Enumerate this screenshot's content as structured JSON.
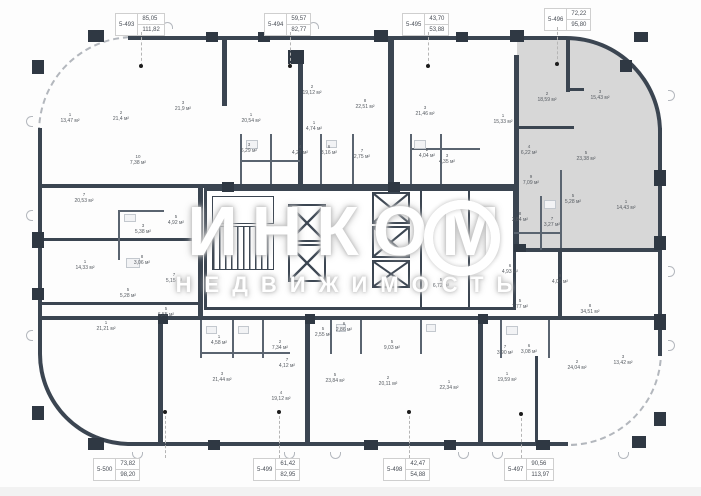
{
  "watermark": {
    "brand": "ИНКОМ",
    "subtitle": "НЕДВИЖИМОСТЬ"
  },
  "area_suffix": "м²",
  "colors": {
    "wall": "#3b4551",
    "highlight": "#d7d7d7",
    "callout_border": "#cfcfcf",
    "label_text": "#555a60",
    "watermark": "#ffffff"
  },
  "units": [
    {
      "id": "5-493",
      "living_area": "85,05",
      "total_area": "111,82",
      "side": "top",
      "cx": 141,
      "cy": 13,
      "dot": {
        "x": 141,
        "y": 66
      }
    },
    {
      "id": "5-494",
      "living_area": "59,57",
      "total_area": "82,77",
      "side": "top",
      "cx": 290,
      "cy": 13,
      "dot": {
        "x": 290,
        "y": 66
      }
    },
    {
      "id": "5-495",
      "living_area": "43,70",
      "total_area": "53,88",
      "side": "top",
      "cx": 428,
      "cy": 13,
      "dot": {
        "x": 428,
        "y": 66
      }
    },
    {
      "id": "5-496",
      "living_area": "72,22",
      "total_area": "95,80",
      "side": "top",
      "cx": 570,
      "cy": 8,
      "dot": {
        "x": 557,
        "y": 64
      }
    },
    {
      "id": "5-497",
      "living_area": "90,56",
      "total_area": "113,97",
      "side": "bottom",
      "cx": 530,
      "cy": 458,
      "dot": {
        "x": 521,
        "y": 414
      }
    },
    {
      "id": "5-498",
      "living_area": "42,47",
      "total_area": "54,88",
      "side": "bottom",
      "cx": 409,
      "cy": 458,
      "dot": {
        "x": 409,
        "y": 412
      }
    },
    {
      "id": "5-499",
      "living_area": "61,42",
      "total_area": "82,95",
      "side": "bottom",
      "cx": 279,
      "cy": 458,
      "dot": {
        "x": 279,
        "y": 412
      }
    },
    {
      "id": "5-500",
      "living_area": "73,82",
      "total_area": "98,20",
      "side": "bottom",
      "cx": 119,
      "cy": 458,
      "dot": {
        "x": 165,
        "y": 412
      }
    }
  ],
  "rooms": [
    {
      "n": "1",
      "area": "13,47",
      "x": 70,
      "y": 112
    },
    {
      "n": "2",
      "area": "21,4",
      "x": 121,
      "y": 110
    },
    {
      "n": "3",
      "area": "21,9",
      "x": 183,
      "y": 100
    },
    {
      "n": "10",
      "area": "7,38",
      "x": 138,
      "y": 154
    },
    {
      "n": "7",
      "area": "20,53",
      "x": 84,
      "y": 192
    },
    {
      "n": "5",
      "area": "4,92",
      "x": 176,
      "y": 214
    },
    {
      "n": "3",
      "area": "5,38",
      "x": 143,
      "y": 223
    },
    {
      "n": "8",
      "area": "3,06",
      "x": 142,
      "y": 254
    },
    {
      "n": "1",
      "area": "14,33",
      "x": 85,
      "y": 259
    },
    {
      "n": "7",
      "area": "5,15",
      "x": 174,
      "y": 272
    },
    {
      "n": "5",
      "area": "5,28",
      "x": 128,
      "y": 287
    },
    {
      "n": "1",
      "area": "21,21",
      "x": 106,
      "y": 320
    },
    {
      "n": "5",
      "area": "6,55",
      "x": 166,
      "y": 306
    },
    {
      "n": "1",
      "area": "20,54",
      "x": 251,
      "y": 112
    },
    {
      "n": "2",
      "area": "19,12",
      "x": 312,
      "y": 84
    },
    {
      "n": "3",
      "area": "6,29",
      "x": 249,
      "y": 142
    },
    {
      "n": "4",
      "area": "4,27",
      "x": 300,
      "y": 144
    },
    {
      "n": "1",
      "area": "4,74",
      "x": 314,
      "y": 120
    },
    {
      "n": "6",
      "area": "3,16",
      "x": 329,
      "y": 144
    },
    {
      "n": "8",
      "area": "22,51",
      "x": 365,
      "y": 98
    },
    {
      "n": "7",
      "area": "2,75",
      "x": 362,
      "y": 148
    },
    {
      "n": "3",
      "area": "21,46",
      "x": 425,
      "y": 105
    },
    {
      "n": "2",
      "area": "4,04",
      "x": 427,
      "y": 147
    },
    {
      "n": "3",
      "area": "4,35",
      "x": 447,
      "y": 153
    },
    {
      "n": "1",
      "area": "15,33",
      "x": 503,
      "y": 113
    },
    {
      "n": "2",
      "area": "18,59",
      "x": 547,
      "y": 91
    },
    {
      "n": "3",
      "area": "15,43",
      "x": 600,
      "y": 89
    },
    {
      "n": "4",
      "area": "6,22",
      "x": 529,
      "y": 144
    },
    {
      "n": "5",
      "area": "23,38",
      "x": 586,
      "y": 150
    },
    {
      "n": "9",
      "area": "7,09",
      "x": 531,
      "y": 174
    },
    {
      "n": "5",
      "area": "5,28",
      "x": 573,
      "y": 193
    },
    {
      "n": "1",
      "area": "14,43",
      "x": 626,
      "y": 199
    },
    {
      "n": "8",
      "area": "3,84",
      "x": 520,
      "y": 211
    },
    {
      "n": "7",
      "area": "3,27",
      "x": 552,
      "y": 216
    },
    {
      "n": "6",
      "area": "4,93",
      "x": 510,
      "y": 263
    },
    {
      "n": "9",
      "area": "4,05",
      "x": 560,
      "y": 273
    },
    {
      "n": "5",
      "area": "7,77",
      "x": 520,
      "y": 298
    },
    {
      "n": "8",
      "area": "34,51",
      "x": 590,
      "y": 303
    },
    {
      "n": "7",
      "area": "3,90",
      "x": 505,
      "y": 344
    },
    {
      "n": "6",
      "area": "3,08",
      "x": 529,
      "y": 343
    },
    {
      "n": "1",
      "area": "19,59",
      "x": 507,
      "y": 371
    },
    {
      "n": "2",
      "area": "24,04",
      "x": 577,
      "y": 359
    },
    {
      "n": "3",
      "area": "13,42",
      "x": 623,
      "y": 354
    },
    {
      "n": "5",
      "area": "6,72",
      "x": 441,
      "y": 277
    },
    {
      "n": "1",
      "area": "22,34",
      "x": 449,
      "y": 379
    },
    {
      "n": "5",
      "area": "9,03",
      "x": 392,
      "y": 339
    },
    {
      "n": "5",
      "area": "23,84",
      "x": 335,
      "y": 372
    },
    {
      "n": "2",
      "area": "20,11",
      "x": 388,
      "y": 375
    },
    {
      "n": "5",
      "area": "2,55",
      "x": 323,
      "y": 326
    },
    {
      "n": "6",
      "area": "2,86",
      "x": 344,
      "y": 321
    },
    {
      "n": "1",
      "area": "4,58",
      "x": 219,
      "y": 334
    },
    {
      "n": "2",
      "area": "7,34",
      "x": 280,
      "y": 339
    },
    {
      "n": "7",
      "area": "4,12",
      "x": 287,
      "y": 357
    },
    {
      "n": "3",
      "area": "21,44",
      "x": 222,
      "y": 371
    },
    {
      "n": "4",
      "area": "19,12",
      "x": 281,
      "y": 390
    }
  ]
}
